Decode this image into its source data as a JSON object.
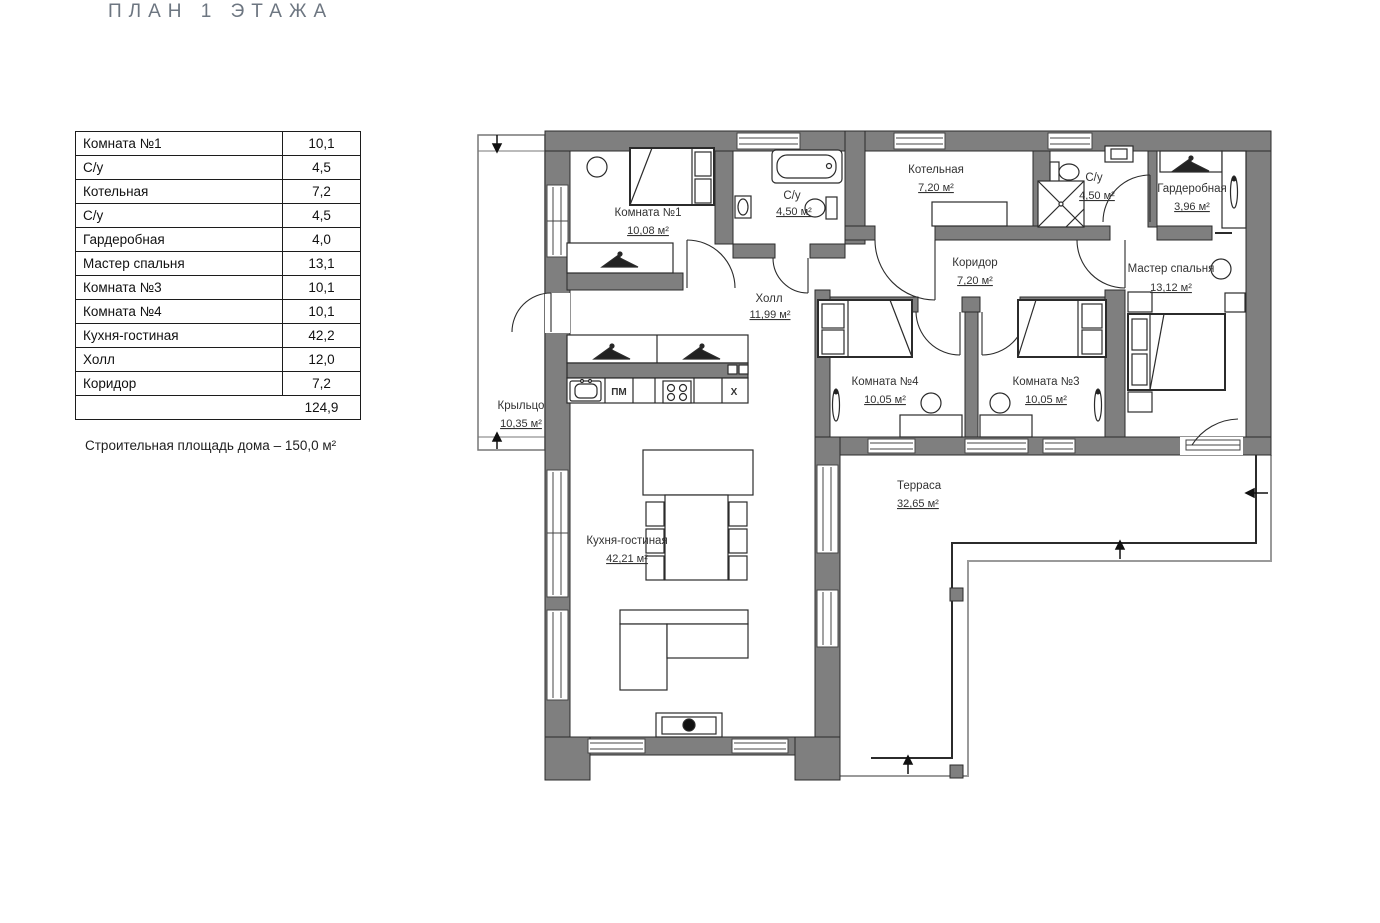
{
  "title": "ПЛАН 1 ЭТАЖА",
  "legend_table": {
    "rows": [
      {
        "label": "Комната №1",
        "value": "10,1"
      },
      {
        "label": "С/у",
        "value": "4,5"
      },
      {
        "label": "Котельная",
        "value": "7,2"
      },
      {
        "label": "С/у",
        "value": "4,5"
      },
      {
        "label": "Гардеробная",
        "value": "4,0"
      },
      {
        "label": "Мастер спальня",
        "value": "13,1"
      },
      {
        "label": "Комната №3",
        "value": "10,1"
      },
      {
        "label": "Комната №4",
        "value": "10,1"
      },
      {
        "label": "Кухня-гостиная",
        "value": "42,2"
      },
      {
        "label": "Холл",
        "value": "12,0"
      },
      {
        "label": "Коридор",
        "value": "7,2"
      }
    ],
    "total": "124,9"
  },
  "note": "Строительная площадь дома – 150,0 м²",
  "plan": {
    "rooms": [
      {
        "name": "Комната №1",
        "area": "10,08 м²"
      },
      {
        "name": "С/у",
        "area": "4,50 м²"
      },
      {
        "name": "Котельная",
        "area": "7,20 м²"
      },
      {
        "name": "С/у",
        "area": "4,50 м²"
      },
      {
        "name": "Гардеробная",
        "area": "3,96 м²"
      },
      {
        "name": "Коридор",
        "area": "7,20 м²"
      },
      {
        "name": "Мастер спальня",
        "area": "13,12 м²"
      },
      {
        "name": "Холл",
        "area": "11,99 м²"
      },
      {
        "name": "Комната №4",
        "area": "10,05 м²"
      },
      {
        "name": "Комната №3",
        "area": "10,05 м²"
      },
      {
        "name": "Крыльцо",
        "area": "10,35 м²"
      },
      {
        "name": "Кухня-гостиная",
        "area": "42,21 м²"
      },
      {
        "name": "Терраса",
        "area": "32,65 м²"
      }
    ],
    "kitchen": {
      "dishwasher_label": "ПМ",
      "fridge_label": "Х"
    }
  },
  "colors": {
    "wall": "#7f7f7f",
    "line": "#2b2b2b",
    "title": "#6d7681"
  }
}
